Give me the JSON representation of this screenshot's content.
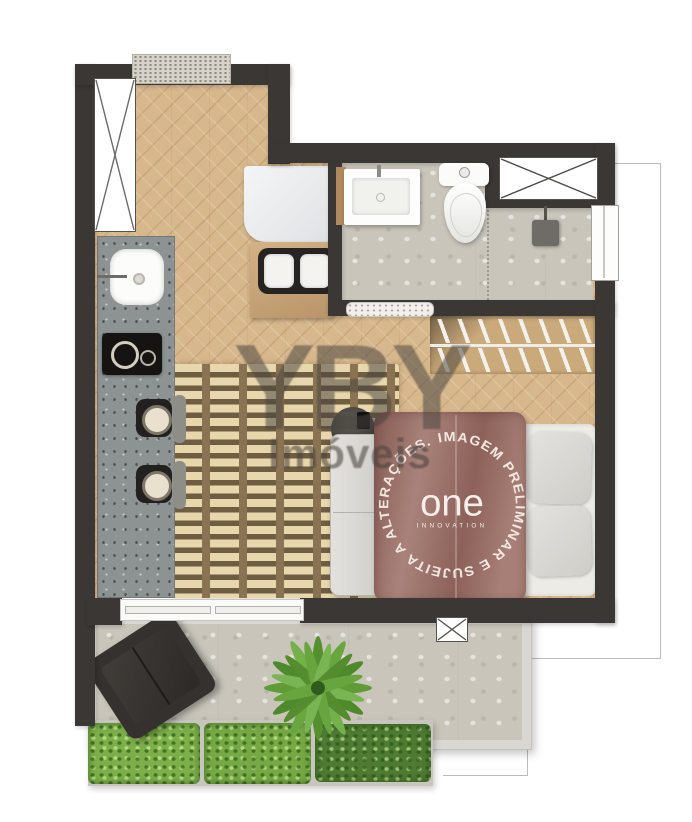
{
  "watermark": {
    "brand": "YBY",
    "subtitle": "Imóveis"
  },
  "bed_print": {
    "disclaimer": "IMAGEM PRELIMINAR E SUJEITA A ALTERAÇÕES.  ",
    "logo": "one",
    "logo_sub": "INNOVATION"
  },
  "colors": {
    "wall": "#3b3734",
    "wood_floor": "#d7b78c",
    "stone_floor": "#c9c5bb",
    "kitchen_counter": "#8d9293",
    "duvet": "#9d7168",
    "hedge_light": "#7cae4a",
    "hedge_dark": "#4e7a33",
    "watermark_gray": "#484439"
  },
  "plan": {
    "type": "studio-apartment-floor-plan",
    "furniture": [
      "entry-doormat",
      "utility-shaft",
      "kitchen-counter",
      "kitchen-sink",
      "cooktop",
      "bar-stool",
      "bar-stool",
      "white-cabinet",
      "dining-table",
      "dining-chair",
      "dining-chair",
      "bathroom-vanity",
      "toilet",
      "shower-head",
      "bathroom-window",
      "side-window",
      "closet-hanger-rails",
      "knit-rug",
      "bench",
      "side-table-lamp",
      "double-bed",
      "pillow",
      "pillow",
      "sliding-door-bathroom",
      "sliding-door-balcony",
      "balcony-armchair",
      "palm-plant",
      "planter-hedge",
      "planter-hedge",
      "planter-hedge",
      "column-marker"
    ]
  }
}
